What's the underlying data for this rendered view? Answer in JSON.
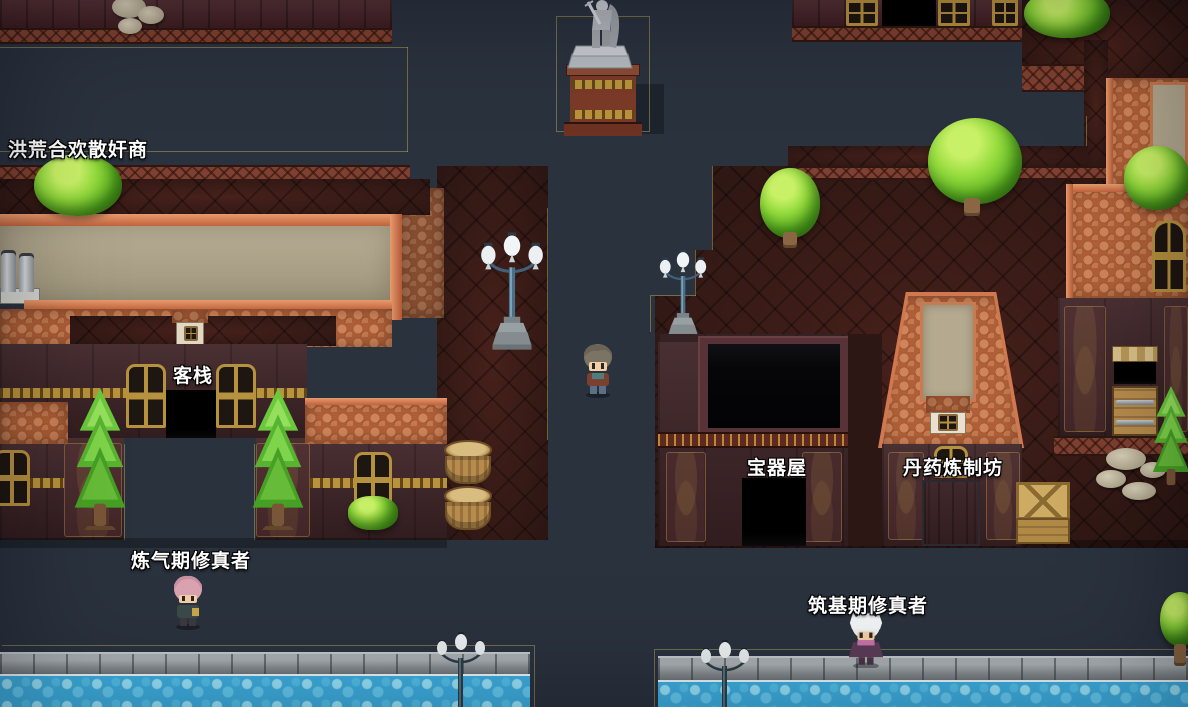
{
  "scene": {
    "labels": {
      "merchant": "洪荒合欢散奸商",
      "inn": "客栈",
      "treasure_shop": "宝器屋",
      "pill_workshop": "丹药炼制坊",
      "npc_qi_refining": "炼气期修真者",
      "npc_foundation": "筑基期修真者"
    },
    "colors": {
      "road": "#2a323e",
      "terrace_red": "#381d19",
      "roof_tile_orange": "#b06038",
      "roof_flat_beige": "#b1a68a",
      "wall_maroon": "#402528",
      "trim_orange": "#7e4030",
      "gold_trim": "#c9a44a",
      "water_blue": "#3fb0e2",
      "tree_green": "#7cc832",
      "label_text": "#ffffff"
    }
  }
}
